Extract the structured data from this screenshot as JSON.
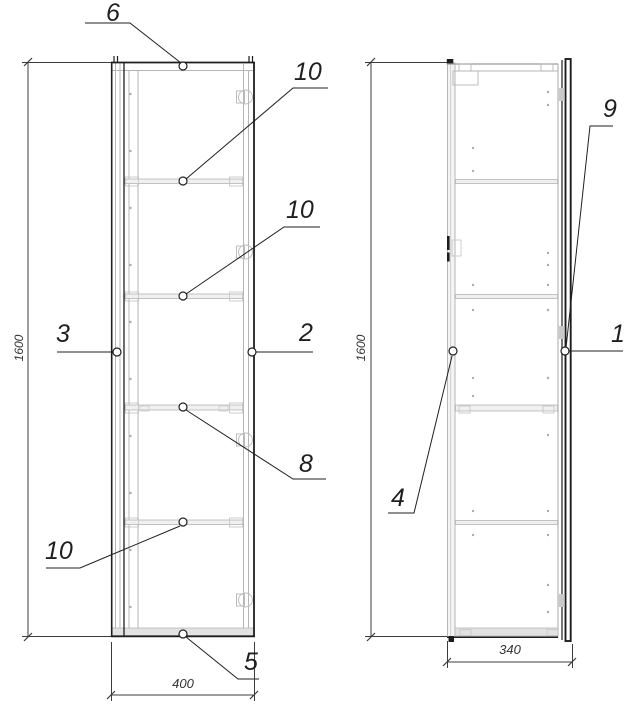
{
  "drawing": {
    "type": "furniture-assembly-drawing",
    "views_count": 2,
    "colors": {
      "line_dark": "#1d1d1d",
      "line_light": "#b6b6b6",
      "dim_line": "#3c3c3c",
      "text": "#1f1f1f",
      "background": "#ffffff"
    }
  },
  "front_view": {
    "label": "front-view",
    "dimensions": {
      "height": "1600",
      "width": "400"
    },
    "callouts": {
      "top_panel": "6",
      "shelf_pin_upper": "10",
      "shelf_pin_middle": "10",
      "left_side": "3",
      "right_side": "2",
      "middle_shelf": "8",
      "shelf_pin_lower": "10",
      "bottom_panel": "5"
    }
  },
  "side_view": {
    "label": "side-view",
    "dimensions": {
      "height": "1600",
      "depth": "340"
    },
    "callouts": {
      "door": "1",
      "back_panel": "4",
      "door_edge": "9"
    }
  }
}
